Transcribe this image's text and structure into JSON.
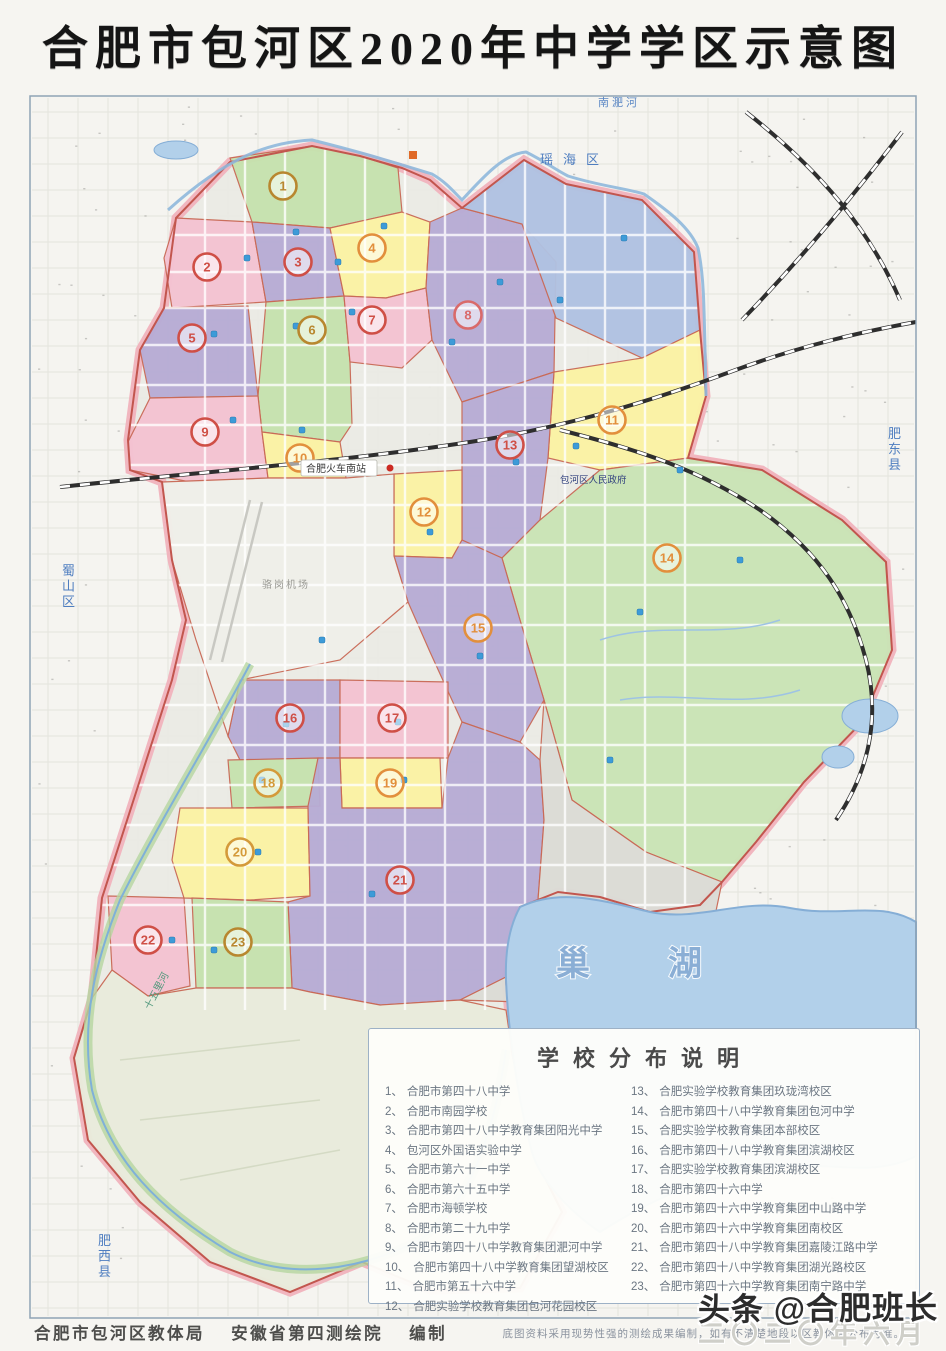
{
  "title": "合肥市包河区2020年中学学区示意图",
  "legend": {
    "title": "学校分布说明",
    "items_left": [
      {
        "num": "1、",
        "name": "合肥市第四十八中学"
      },
      {
        "num": "2、",
        "name": "合肥市南园学校"
      },
      {
        "num": "3、",
        "name": "合肥市第四十八中学教育集团阳光中学"
      },
      {
        "num": "4、",
        "name": "包河区外国语实验中学"
      },
      {
        "num": "5、",
        "name": "合肥市第六十一中学"
      },
      {
        "num": "6、",
        "name": "合肥市第六十五中学"
      },
      {
        "num": "7、",
        "name": "合肥市海顿学校"
      },
      {
        "num": "8、",
        "name": "合肥市第二十九中学"
      },
      {
        "num": "9、",
        "name": "合肥市第四十八中学教育集团淝河中学"
      },
      {
        "num": "10、",
        "name": "合肥市第四十八中学教育集团望湖校区"
      },
      {
        "num": "11、",
        "name": "合肥市第五十六中学"
      },
      {
        "num": "12、",
        "name": "合肥实验学校教育集团包河花园校区"
      }
    ],
    "items_right": [
      {
        "num": "13、",
        "name": "合肥实验学校教育集团玖珑湾校区"
      },
      {
        "num": "14、",
        "name": "合肥市第四十八中学教育集团包河中学"
      },
      {
        "num": "15、",
        "name": "合肥实验学校教育集团本部校区"
      },
      {
        "num": "16、",
        "name": "合肥市第四十八中学教育集团滨湖校区"
      },
      {
        "num": "17、",
        "name": "合肥实验学校教育集团滨湖校区"
      },
      {
        "num": "18、",
        "name": "合肥市第四十六中学"
      },
      {
        "num": "19、",
        "name": "合肥市第四十六中学教育集团中山路中学"
      },
      {
        "num": "20、",
        "name": "合肥市第四十六中学教育集团南校区"
      },
      {
        "num": "21、",
        "name": "合肥市第四十八中学教育集团嘉陵江路中学"
      },
      {
        "num": "22、",
        "name": "合肥市第四十八中学教育集团湖光路校区"
      },
      {
        "num": "23、",
        "name": "合肥市第四十六中学教育集团南宁路中学"
      }
    ],
    "note": "底图资料采用现势性强的测绘成果编制，如有不清楚地段以区教体局公布为准。"
  },
  "footer": {
    "credits": "合肥市包河区教体局　 安徽省第四测绘院　 编制"
  },
  "watermark": {
    "text": "头条 @合肥班长",
    "date": "二〇二〇年六月"
  },
  "map": {
    "colors": {
      "bg": "#f5f4f0",
      "grid": "#e3e3dc",
      "band": "#f1b3bd",
      "redline": "#c2564e",
      "zone_stroke": "#c96a57",
      "pink": "#f4c3d2",
      "purple": "#b7acd5",
      "yellow": "#fbf3a4",
      "green": "#c6e2ae",
      "biggreen": "#cae4b6",
      "blue": "#b0c2e2",
      "greyA": "#f0f0ea",
      "greyB": "#dcdcd6",
      "swtint": "#e9ecdc",
      "lake": "#b2d0ea",
      "lake_edge": "#85aed6",
      "road": "#ffffff",
      "rail": "#2e2e2e",
      "river": "#8fb8dc",
      "greenway": "#b5d6a0"
    },
    "silhouette": "M176,218 L230,162 L312,146 L360,156 L402,168 L430,180 L462,208 L524,160 L566,184 L642,200 L694,252 L700,330 L706,396 L688,458 L762,470 L842,520 L886,562 L892,650 L862,722 L804,782 L756,842 L722,882 L700,905 L650,912 L600,897 L558,892 L520,907 L506,980 L512,1052 L532,1152 L562,1212 L520,1288 L430,1290 L362,1262 L290,1292 L210,1262 L140,1202 L88,1140 L74,1058 L92,998 L102,898 L140,780 L172,680 L186,620 L172,560 L162,482 L130,470 L128,440 L140,350 L164,308 Z",
    "zones": [
      {
        "id": "zone-1",
        "num": "1",
        "fill": "green",
        "badge": [
          283,
          186
        ],
        "bc": "#b8872f",
        "poly": "230,158 312,146 360,156 398,168 402,212 330,228 252,222"
      },
      {
        "id": "zone-2",
        "num": "2",
        "fill": "pink",
        "badge": [
          207,
          267
        ],
        "bc": "#cf4f46",
        "poly": "176,218 252,222 266,302 172,308 164,258"
      },
      {
        "id": "zone-3",
        "num": "3",
        "fill": "purple",
        "badge": [
          298,
          262
        ],
        "bc": "#cf4f46",
        "poly": "252,222 330,228 344,296 266,302"
      },
      {
        "id": "zone-4",
        "num": "4",
        "fill": "yellow",
        "badge": [
          372,
          248
        ],
        "bc": "#e28f3c",
        "poly": "330,228 402,212 430,222 426,288 386,298 344,296"
      },
      {
        "id": "zone-5",
        "num": "5",
        "fill": "purple",
        "badge": [
          192,
          338
        ],
        "bc": "#cf4f46",
        "poly": "164,308 248,306 258,396 150,398 140,350"
      },
      {
        "id": "zone-6",
        "num": "6",
        "fill": "green",
        "badge": [
          312,
          330
        ],
        "bc": "#b8872f",
        "poly": "266,302 344,296 350,362 352,424 340,442 262,432 258,396"
      },
      {
        "id": "zone-7",
        "num": "7",
        "fill": "pink",
        "badge": [
          372,
          320
        ],
        "bc": "#cf4f46",
        "poly": "344,296 386,298 426,288 432,340 402,368 350,362"
      },
      {
        "id": "zone-8",
        "num": "8",
        "fill": "purple",
        "badge": [
          468,
          315
        ],
        "bc": "#d96a6a",
        "poly": "426,288 430,222 462,208 522,224 556,262 554,372 462,402 432,340"
      },
      {
        "id": "zone-ne",
        "num": "",
        "fill": "blue",
        "badge": null,
        "bc": "",
        "poly": "462,208 524,160 566,184 642,200 694,252 700,330 642,358 556,318 522,224"
      },
      {
        "id": "zone-9",
        "num": "9",
        "fill": "pink",
        "badge": [
          205,
          432
        ],
        "bc": "#cf4f46",
        "poly": "150,398 258,396 262,432 268,478 190,482 130,470 128,442"
      },
      {
        "id": "zone-10",
        "num": "10",
        "fill": "yellow",
        "badge": [
          300,
          458
        ],
        "bc": "#e28f3c",
        "poly": "262,432 340,442 346,478 268,478"
      },
      {
        "id": "zone-11",
        "num": "11",
        "fill": "yellow",
        "badge": [
          612,
          420
        ],
        "bc": "#e28f3c",
        "poly": "554,372 642,358 700,330 706,396 688,458 600,470 548,458"
      },
      {
        "id": "zone-13",
        "num": "13",
        "fill": "purple",
        "badge": [
          510,
          445
        ],
        "bc": "#cf4f46",
        "poly": "462,402 554,372 548,458 540,520 502,558 462,540"
      },
      {
        "id": "zone-12",
        "num": "12",
        "fill": "yellow",
        "badge": [
          424,
          512
        ],
        "bc": "#e28f3c",
        "poly": "394,474 462,470 462,540 452,558 394,556"
      },
      {
        "id": "zone-14",
        "num": "14",
        "fill": "biggreen",
        "badge": [
          667,
          558
        ],
        "bc": "#e28f3c",
        "poly": "540,520 600,470 688,458 762,470 842,520 886,562 892,650 862,722 804,782 756,842 722,882 646,852 572,800 544,700 520,620 502,558"
      },
      {
        "id": "zone-15",
        "num": "15",
        "fill": "purple",
        "badge": [
          478,
          628
        ],
        "bc": "#e28f3c",
        "poly": "394,556 452,558 462,540 502,558 520,620 544,700 520,742 462,722 430,652 408,602"
      },
      {
        "id": "zone-16",
        "num": "16",
        "fill": "purple",
        "badge": [
          290,
          718
        ],
        "bc": "#cf4f46",
        "poly": "240,680 340,680 340,758 240,760 228,736"
      },
      {
        "id": "zone-17",
        "num": "17",
        "fill": "pink",
        "badge": [
          392,
          718
        ],
        "bc": "#cf4f46",
        "poly": "340,680 448,682 448,758 340,758"
      },
      {
        "id": "zone-18",
        "num": "18",
        "fill": "green",
        "badge": [
          268,
          783
        ],
        "bc": "#d49a3a",
        "poly": "228,760 318,758 320,806 232,808"
      },
      {
        "id": "zone-19",
        "num": "19",
        "fill": "yellow",
        "badge": [
          390,
          783
        ],
        "bc": "#e28f3c",
        "poly": "340,758 440,758 442,808 342,808"
      },
      {
        "id": "zone-20",
        "num": "20",
        "fill": "yellow",
        "badge": [
          240,
          852
        ],
        "bc": "#d49a3a",
        "poly": "180,808 308,808 310,896 250,900 184,898 172,860"
      },
      {
        "id": "zone-21",
        "num": "21",
        "fill": "purple",
        "badge": [
          400,
          880
        ],
        "bc": "#cf4f46",
        "poly": "318,758 340,758 342,808 442,808 448,758 462,722 520,742 540,760 544,820 538,900 520,970 460,1000 380,1005 310,992 292,988 288,902 310,896 308,806"
      },
      {
        "id": "zone-22",
        "num": "22",
        "fill": "pink",
        "badge": [
          148,
          940
        ],
        "bc": "#cf4f46",
        "poly": "108,896 184,898 190,986 148,996 112,970"
      },
      {
        "id": "zone-23",
        "num": "23",
        "fill": "green",
        "badge": [
          238,
          942
        ],
        "bc": "#b8872f",
        "poly": "192,898 288,902 292,988 196,988"
      },
      {
        "id": "area-airport",
        "num": "",
        "fill": "greyA",
        "badge": null,
        "bc": "",
        "poly": "162,482 268,478 346,478 394,474 394,556 408,602 340,660 240,680 228,736 196,640 172,560"
      },
      {
        "id": "area-center-grey",
        "num": "",
        "fill": "greyB",
        "badge": null,
        "bc": "",
        "poly": "544,700 572,800 646,852 722,882 710,940 620,1008 520,1002 460,1000 520,970 538,900 544,820 540,760"
      },
      {
        "id": "area-southwest-farm",
        "num": "",
        "fill": "swtint",
        "badge": null,
        "bc": "",
        "poly": "92,998 112,970 148,996 196,988 292,988 310,992 380,1005 460,1000 506,1010 512,1052 532,1152 562,1212 520,1288 430,1290 362,1262 290,1292 210,1262 140,1202 88,1140 74,1058"
      }
    ],
    "lake": "M520,907 C560,888 600,900 650,912 C700,922 740,898 790,908 C840,918 880,900 916,922 L916,1156 C870,1180 820,1158 760,1168 C700,1178 650,1200 600,1232 C570,1212 540,1180 532,1152 C518,1100 508,1030 506,980 C505,950 510,925 520,907 Z",
    "ponds": [
      [
        176,
        150,
        22,
        9
      ],
      [
        870,
        716,
        28,
        17
      ],
      [
        838,
        757,
        16,
        11
      ]
    ],
    "railways": [
      "M60,487 C200,472 340,462 470,442 C560,428 640,405 730,372 C800,346 860,332 916,322",
      "M560,430 C640,450 700,470 760,510 C820,552 850,600 866,660 C880,716 870,770 836,820",
      "M746,112 C820,170 870,230 900,300",
      "M902,132 C850,200 800,260 742,320"
    ],
    "rivers": [
      "M168,210 C228,156 270,142 312,140 C352,150 380,158 432,174 C446,182 454,192 462,200 C484,176 504,154 526,152 C546,162 556,170 568,176 C600,186 624,188 644,194 C670,212 690,228 698,248 C704,276 704,300 706,396"
    ],
    "greenway": "M250,664 C210,740 160,820 120,900 C96,960 80,1020 92,1090 C110,1160 160,1210 230,1252 C290,1282 360,1270 420,1240 C460,1210 490,1160 506,1050",
    "streams": [
      "M600,640 C660,620 720,640 780,620",
      "M620,700 C680,690 740,710 800,690"
    ],
    "runway": [
      "M250,500 L210,660",
      "M262,502 L222,662"
    ],
    "fieldlines": [
      "M120,1060 L300,1040",
      "M140,1120 L320,1100",
      "M180,1180 L340,1150"
    ],
    "schools": [
      [
        296,
        232
      ],
      [
        247,
        258
      ],
      [
        338,
        262
      ],
      [
        384,
        226
      ],
      [
        214,
        334
      ],
      [
        296,
        326
      ],
      [
        352,
        312
      ],
      [
        452,
        342
      ],
      [
        233,
        420
      ],
      [
        302,
        430
      ],
      [
        576,
        446
      ],
      [
        430,
        532
      ],
      [
        516,
        462
      ],
      [
        640,
        612
      ],
      [
        480,
        656
      ],
      [
        286,
        724
      ],
      [
        398,
        722
      ],
      [
        262,
        780
      ],
      [
        404,
        780
      ],
      [
        258,
        852
      ],
      [
        214,
        950
      ],
      [
        172,
        940
      ],
      [
        372,
        894
      ],
      [
        322,
        640
      ],
      [
        560,
        300
      ],
      [
        500,
        282
      ],
      [
        624,
        238
      ],
      [
        680,
        470
      ],
      [
        740,
        560
      ],
      [
        610,
        760
      ]
    ],
    "markers": {
      "red_dots": [
        [
          390,
          468
        ]
      ],
      "orange_squares": [
        [
          413,
          155
        ]
      ]
    },
    "labels": [
      {
        "t": "南淝河",
        "x": 598,
        "y": 106,
        "s": 11,
        "c": "#5b87c5",
        "ls": 3
      },
      {
        "t": "瑶海区",
        "x": 540,
        "y": 164,
        "s": 13,
        "c": "#4f7ec0",
        "ls": 10
      },
      {
        "t": "蜀山区",
        "x": 62,
        "y": 575,
        "s": 13,
        "c": "#4f7ec0",
        "v": 1
      },
      {
        "t": "肥西县",
        "x": 98,
        "y": 1245,
        "s": 13,
        "c": "#4f7ec0",
        "v": 1
      },
      {
        "t": "肥东县",
        "x": 888,
        "y": 438,
        "s": 13,
        "c": "#4f7ec0",
        "v": 1
      },
      {
        "t": "巢",
        "x": 556,
        "y": 975,
        "s": 34,
        "c": "#86abd3",
        "o": 1
      },
      {
        "t": "湖",
        "x": 668,
        "y": 975,
        "s": 34,
        "c": "#86abd3",
        "o": 1
      },
      {
        "t": "十五里河",
        "x": 150,
        "y": 1010,
        "s": 10,
        "c": "#52997d",
        "r": -62
      },
      {
        "t": "包河区人民政府",
        "x": 560,
        "y": 483,
        "s": 9.5,
        "c": "#31417e"
      },
      {
        "t": "合肥火车南站",
        "x": 306,
        "y": 472,
        "s": 10,
        "c": "#3a3a3a",
        "bg": 1
      },
      {
        "t": "骆岗机场",
        "x": 262,
        "y": 588,
        "s": 10,
        "c": "#9a9a94",
        "ls": 2
      }
    ]
  }
}
